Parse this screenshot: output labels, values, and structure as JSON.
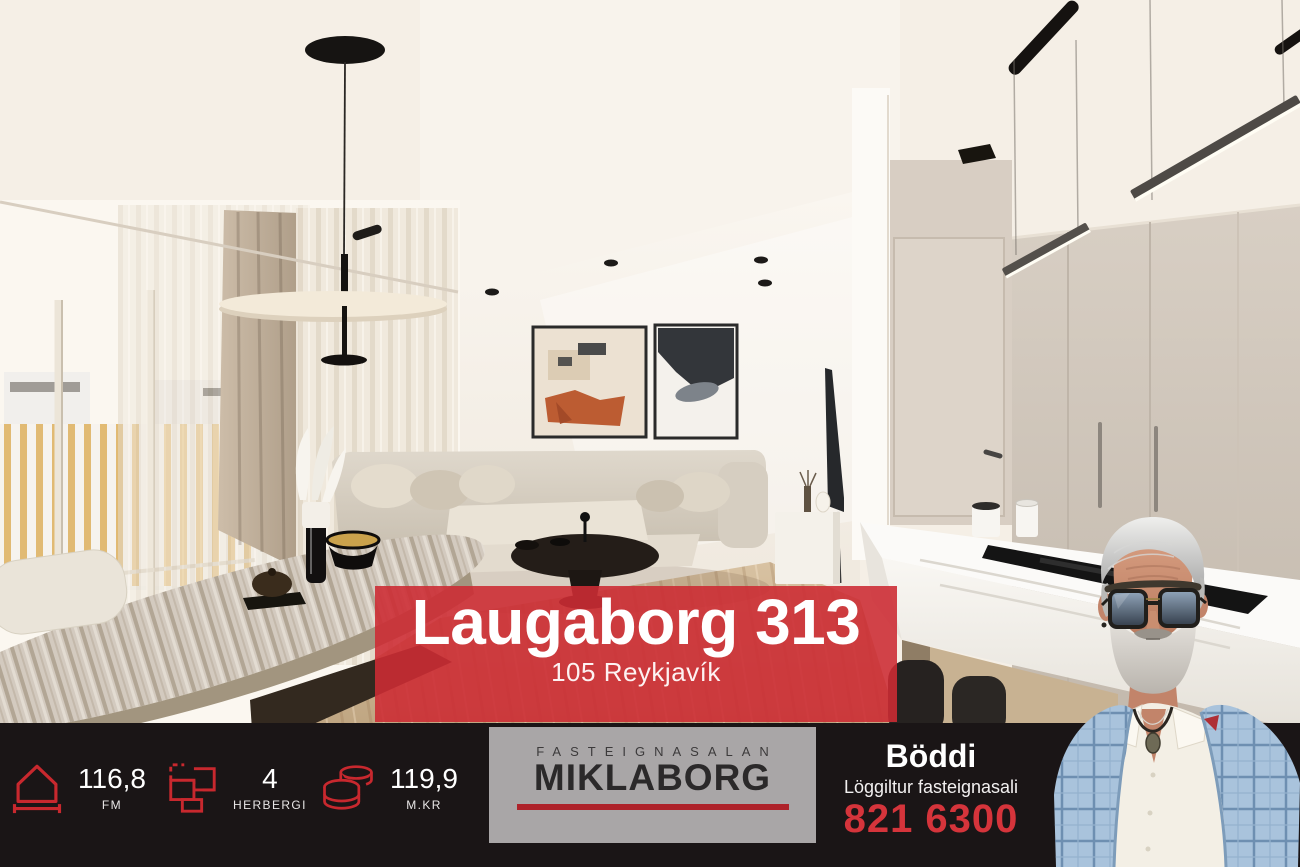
{
  "banner": {
    "title": "Laugaborg 313",
    "subtitle": "105 Reykjavík"
  },
  "stats": [
    {
      "id": "area",
      "icon": "house-measure-icon",
      "value": "116,8",
      "label": "FM"
    },
    {
      "id": "rooms",
      "icon": "floorplan-icon",
      "value": "4",
      "label": "HERBERGI"
    },
    {
      "id": "price",
      "icon": "coins-icon",
      "value": "119,9",
      "label": "M.KR"
    }
  ],
  "logo": {
    "top": "FASTEIGNASALAN",
    "name": "MIKLABORG"
  },
  "agent": {
    "name": "Böddi",
    "title": "Löggiltur fasteignasali",
    "phone": "821 6300"
  },
  "colors": {
    "banner_red": "#cd2c34",
    "accent_red": "#c8282e",
    "phone_red": "#d5343b",
    "logo_underline_red": "#ae222a",
    "bar_background": "#1a1516",
    "logo_box_gray": "#a9a6a7"
  }
}
